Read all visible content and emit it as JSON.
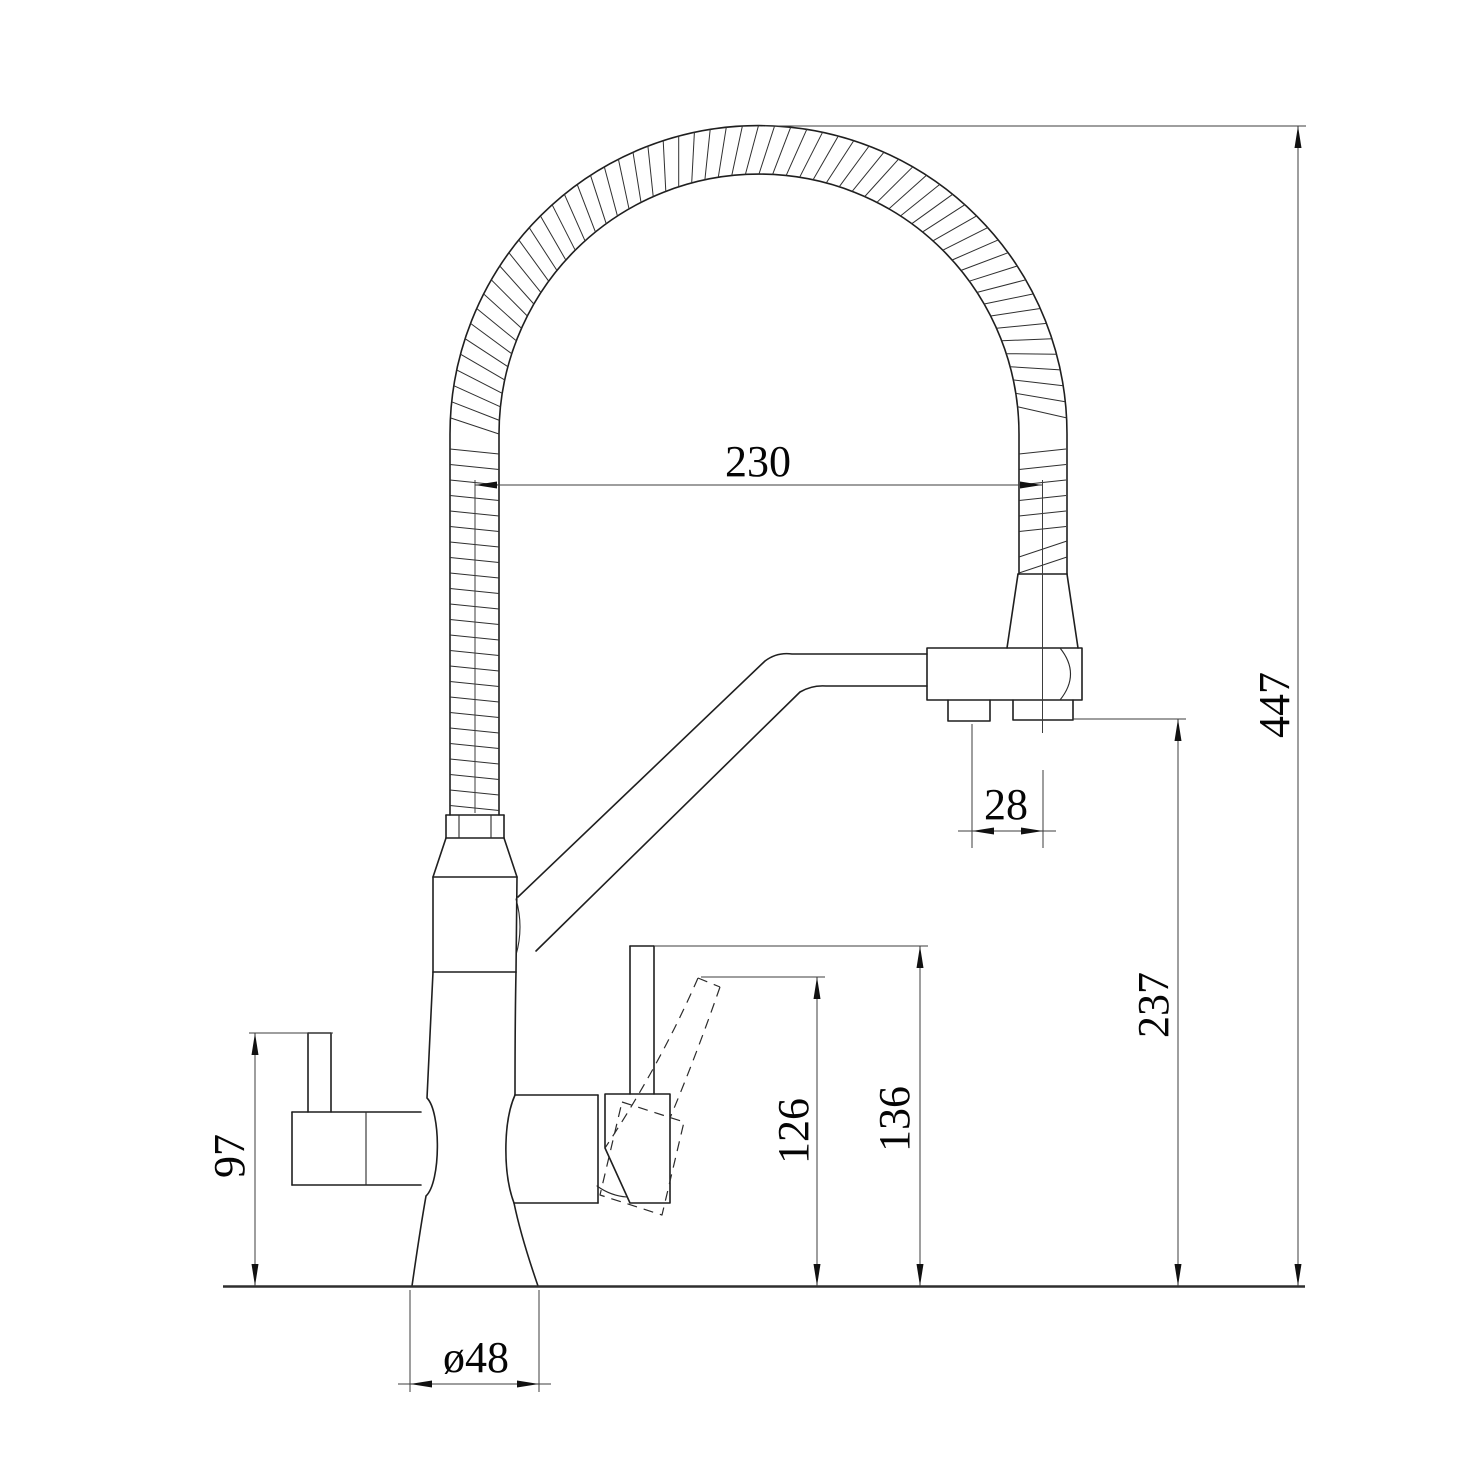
{
  "dimensions": {
    "hose_arch_width": "230",
    "overall_height": "447",
    "spout_underside_height": "237",
    "handle_stem_height": "136",
    "lever_tip_height": "126",
    "side_handle_height": "97",
    "outlet_offset": "28",
    "base_diameter": "ø48"
  },
  "style": {
    "ink_color": "#1f1f1f",
    "dimension_line_color": "#3d3d3d",
    "background_color": "#ffffff"
  }
}
